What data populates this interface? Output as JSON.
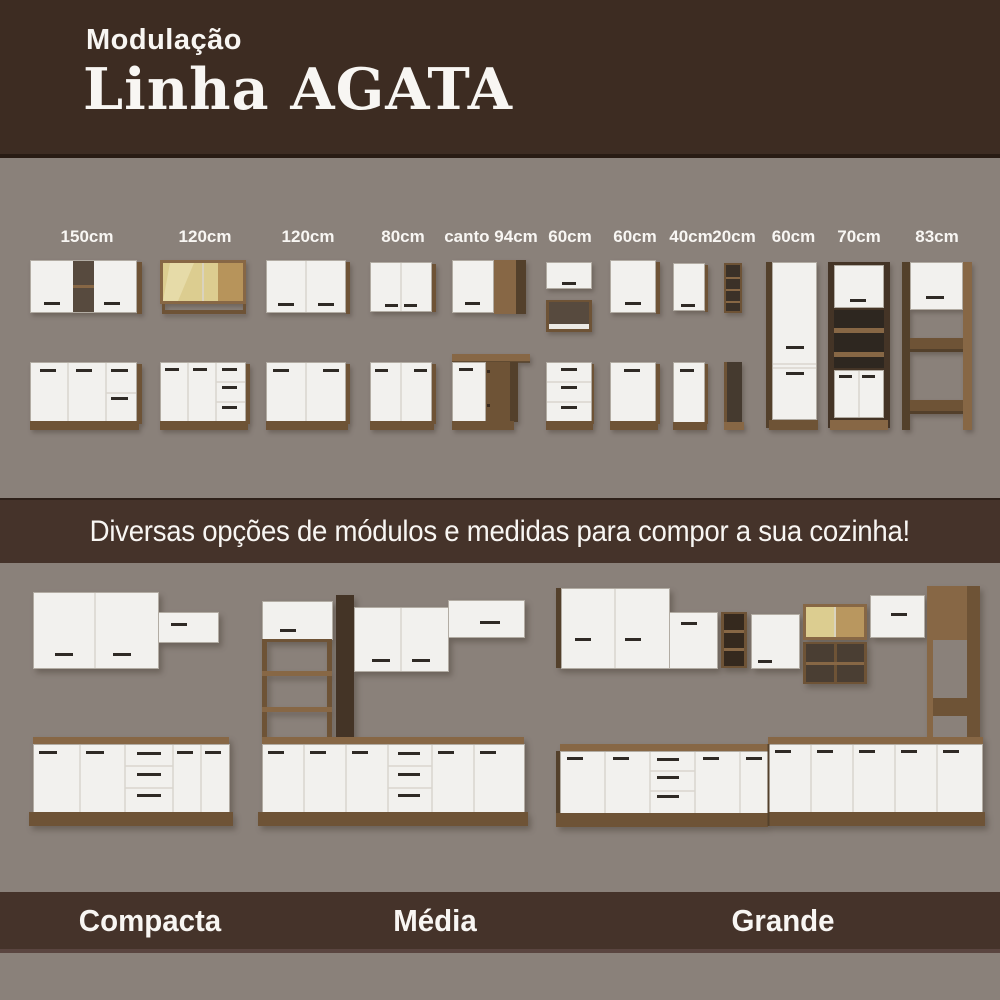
{
  "header": {
    "kicker": "Modulação",
    "title": "Linha AGATA"
  },
  "modules": {
    "labels": [
      "150cm",
      "120cm",
      "120cm",
      "80cm",
      "canto 94cm",
      "60cm",
      "60cm",
      "40cm",
      "20cm",
      "60cm",
      "70cm",
      "83cm"
    ]
  },
  "banner": {
    "text": "Diversas opções de módulos e medidas para compor a sua cozinha!"
  },
  "kitchens": {
    "labels": [
      "Compacta",
      "Média",
      "Grande"
    ]
  },
  "colors": {
    "header_brown": "#3d2c22",
    "band_brown": "#45332a",
    "background_gray": "#8a817a",
    "cabinet_white": "#f2f1ee",
    "wood": "#876745",
    "dark_wood": "#53402b",
    "glass": "#dccd90",
    "text_white": "#f8f6f3"
  }
}
